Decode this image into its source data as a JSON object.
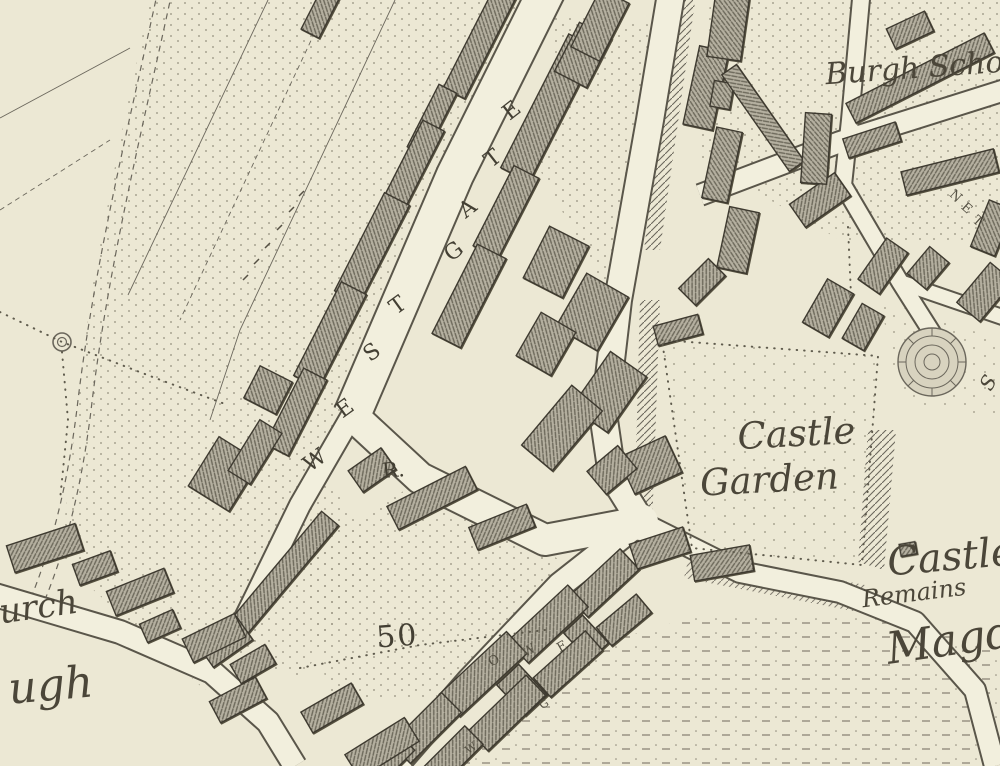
{
  "map": {
    "type": "historical-town-map",
    "palette": {
      "paper": "#ece8d4",
      "road_fill": "#f2efdd",
      "ink": "#4b4639",
      "building": "#b5b0a0",
      "casing": "#5a564a"
    },
    "labels": [
      {
        "id": "burgh-school",
        "text": "Burgh Scho",
        "x": 915,
        "y": 78,
        "rotate": -4,
        "size": 30,
        "class": "place"
      },
      {
        "id": "castle-garden-line1",
        "text": "Castle",
        "x": 797,
        "y": 446,
        "rotate": -3,
        "size": 37,
        "class": "place"
      },
      {
        "id": "castle-garden-line2",
        "text": "Garden",
        "x": 770,
        "y": 492,
        "rotate": -3,
        "size": 37,
        "class": "place"
      },
      {
        "id": "castle-remains-line1",
        "text": "Castle",
        "x": 952,
        "y": 570,
        "rotate": -5,
        "size": 40,
        "class": "place"
      },
      {
        "id": "castle-remains-line2",
        "text": "Remains",
        "x": 915,
        "y": 601,
        "rotate": -7,
        "size": 24,
        "class": "place"
      },
      {
        "id": "magdalene-truncated",
        "text": "Magd",
        "x": 952,
        "y": 655,
        "rotate": -8,
        "size": 44,
        "class": "place"
      },
      {
        "id": "church-truncated",
        "text": "urch",
        "x": 40,
        "y": 618,
        "rotate": -8,
        "size": 34,
        "class": "place"
      },
      {
        "id": "burgh-truncated",
        "text": "ugh",
        "x": 52,
        "y": 700,
        "rotate": -5,
        "size": 44,
        "class": "place"
      },
      {
        "id": "r-abbrev",
        "text": "R.",
        "x": 394,
        "y": 477,
        "rotate": -5,
        "size": 21,
        "class": "caps"
      },
      {
        "id": "benchmark-50",
        "text": "50",
        "x": 398,
        "y": 646,
        "rotate": -4,
        "size": 30,
        "class": "num"
      },
      {
        "id": "s-fragment",
        "text": "S",
        "x": 994,
        "y": 386,
        "rotate": -60,
        "size": 20,
        "class": "place"
      }
    ],
    "street_name_westgate": {
      "word": "WESTGATE",
      "letters": [
        {
          "ch": "W",
          "x": 319,
          "y": 466,
          "rotate": -36
        },
        {
          "ch": "E",
          "x": 349,
          "y": 414,
          "rotate": -36
        },
        {
          "ch": "S",
          "x": 376,
          "y": 358,
          "rotate": -36
        },
        {
          "ch": "T",
          "x": 402,
          "y": 311,
          "rotate": -36
        },
        {
          "ch": "G",
          "x": 458,
          "y": 257,
          "rotate": -38
        },
        {
          "ch": "A",
          "x": 472,
          "y": 214,
          "rotate": -38
        },
        {
          "ch": "T",
          "x": 497,
          "y": 164,
          "rotate": -38
        },
        {
          "ch": "E",
          "x": 516,
          "y": 116,
          "rotate": -38
        }
      ],
      "size": 22
    },
    "street_name_nether_fragment": {
      "letters": [
        {
          "ch": "N",
          "x": 953,
          "y": 199,
          "rotate": 42
        },
        {
          "ch": "E",
          "x": 964,
          "y": 211,
          "rotate": 42
        },
        {
          "ch": "T",
          "x": 975,
          "y": 224,
          "rotate": 42
        }
      ],
      "size": 13
    },
    "small_road_letters": [
      {
        "ch": "O",
        "x": 496,
        "y": 664,
        "rotate": -30,
        "size": 13
      },
      {
        "ch": "W",
        "x": 531,
        "y": 654,
        "rotate": -30,
        "size": 13
      },
      {
        "ch": "E",
        "x": 564,
        "y": 650,
        "rotate": -30,
        "size": 13
      },
      {
        "ch": "G",
        "x": 546,
        "y": 707,
        "rotate": -35,
        "size": 11
      },
      {
        "ch": "W",
        "x": 473,
        "y": 751,
        "rotate": -35,
        "size": 11
      }
    ]
  }
}
